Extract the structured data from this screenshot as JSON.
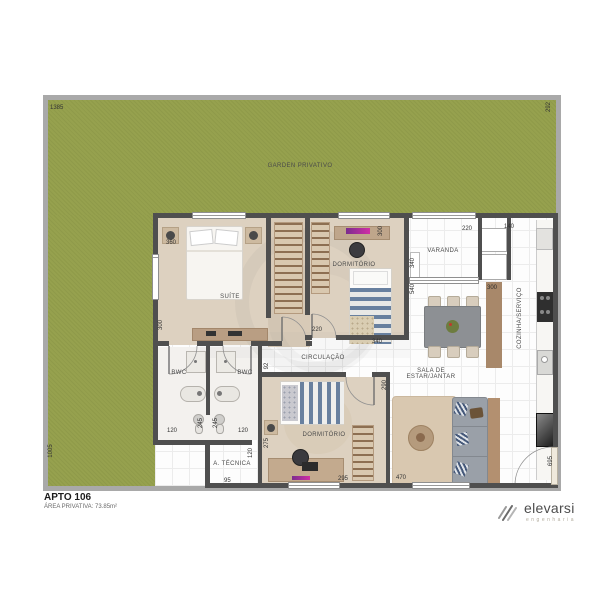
{
  "header": {
    "apto": "APTO 106",
    "area": "ÁREA PRIVATIVA: 73.85m²"
  },
  "brand": {
    "name": "elevarsi",
    "tagline": "engenharia"
  },
  "labels": {
    "garden": "GARDEN PRIVATIVO",
    "suite": "SUÍTE",
    "dorm1": "DORMITÓRIO",
    "dorm2": "DORMITÓRIO",
    "varanda": "VARANDA",
    "sala": "SALA DE\nESTAR/JANTAR",
    "cozinha": "COZINHA/SERVIÇO",
    "bwc1": "BWC",
    "bwc2": "BWC",
    "circulacao": "CIRCULAÇÃO",
    "atecnica": "A. TÉCNICA"
  },
  "dims": {
    "garden_top": "1385",
    "garden_right": "292",
    "garden_left": "1005",
    "suite_width": "360",
    "suite_wall_left": "300",
    "dorm1_width_top": "300",
    "wall_340": "340",
    "wall_540": "540",
    "dorm1_door": "220",
    "dorm1_width_bottom": "340",
    "varanda_width": "220",
    "varanda_depth": "140",
    "kitchen_top": "300",
    "circ_width": "92",
    "bwc1_width": "120",
    "bwc1_depth": "245",
    "bwc2_depth": "245",
    "bwc2_width": "120",
    "dorm2_left": "275",
    "dorm2_right": "290",
    "dorm2_width": "295",
    "sala_width": "470",
    "entry_height": "695",
    "atec_height": "120",
    "atec_width": "95"
  },
  "colors": {
    "garden": "#96a14e",
    "wall": "#4f4f4f",
    "accent": "#c53ba6",
    "wood": "#b99e83"
  }
}
